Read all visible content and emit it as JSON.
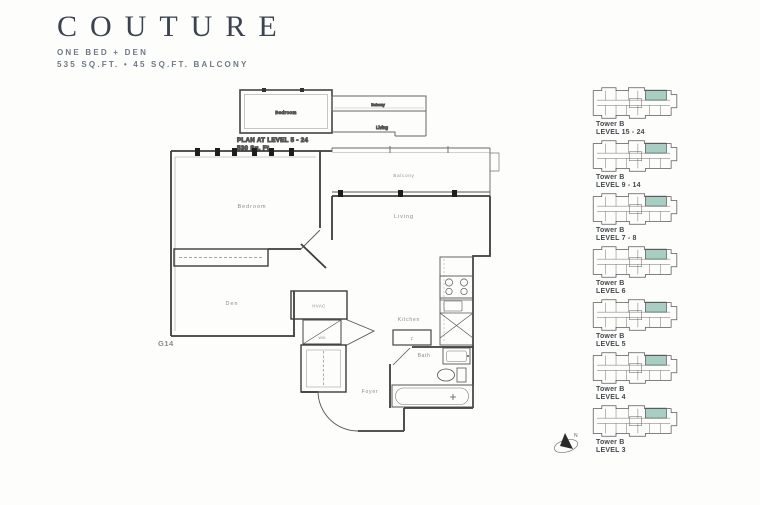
{
  "header": {
    "title": "COUTURE",
    "subtitle_line1": "ONE BED + DEN",
    "subtitle_line2": "535 SQ.FT. • 45 SQ.FT. BALCONY"
  },
  "inset_plan": {
    "caption_line1": "PLAN AT LEVEL 5 - 24",
    "caption_line2": "530 Sq. Ft.",
    "rooms": {
      "bedroom": "Bedroom",
      "balcony": "Balcony",
      "living": "Living"
    }
  },
  "floor_plan": {
    "unit_number": "G14",
    "rooms": {
      "bedroom": "Bedroom",
      "living": "Living",
      "balcony": "Balcony",
      "den": "Den",
      "kitchen": "Kitchen",
      "bath": "Bath",
      "foyer": "Foyer"
    },
    "fixtures": {
      "hvac": "HVAC",
      "washer_dryer": "W/D",
      "fridge": "F"
    }
  },
  "compass": {
    "label": "N"
  },
  "keyplans": [
    {
      "tower": "Tower B",
      "level": "LEVEL 15 - 24"
    },
    {
      "tower": "Tower B",
      "level": "LEVEL 9 - 14"
    },
    {
      "tower": "Tower B",
      "level": "LEVEL 7 - 8"
    },
    {
      "tower": "Tower B",
      "level": "LEVEL 6"
    },
    {
      "tower": "Tower B",
      "level": "LEVEL 5"
    },
    {
      "tower": "Tower B",
      "level": "LEVEL 4"
    },
    {
      "tower": "Tower B",
      "level": "LEVEL 3"
    }
  ],
  "colors": {
    "highlight": "#a8cdc2",
    "highlight_border": "#6fa092",
    "title_text": "#3b4250",
    "subtitle_text": "#6e7887",
    "plan_line": "#3c3c3c"
  }
}
